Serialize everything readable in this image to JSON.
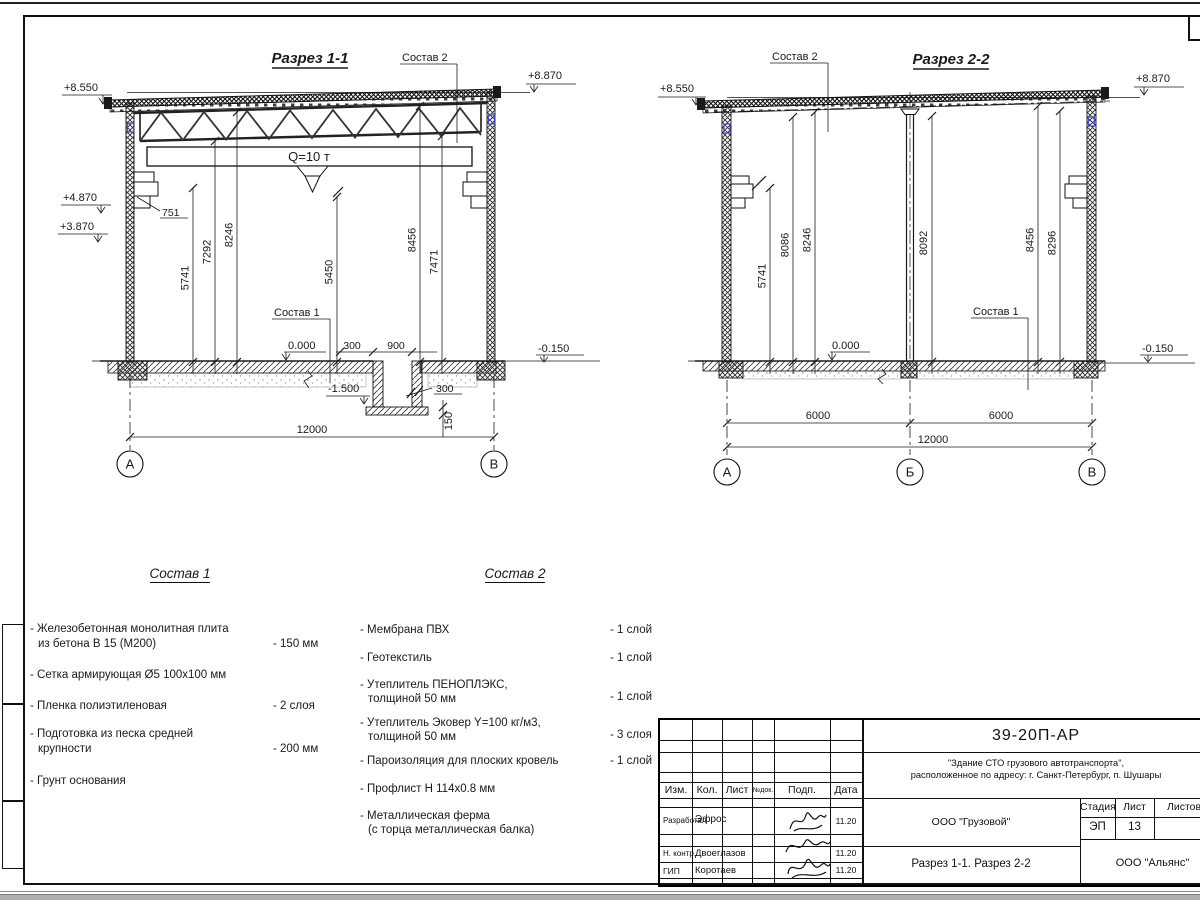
{
  "section1": {
    "title": "Разрез 1-1",
    "sostav2_label": "Состав 2",
    "sostav1_label": "Состав 1",
    "crane_label": "Q=10 т",
    "elev_left_top": "+8.550",
    "elev_right_top": "+8.870",
    "elev_l1": "+4.870",
    "elev_l2": "+3.870",
    "lvl_zero": "0.000",
    "lvl_minus015": "-0.150",
    "lvl_minus150": "-1.500",
    "dim_751": "751",
    "dim_v1": "5741",
    "dim_v2": "7292",
    "dim_v3": "8246",
    "dim_v4": "5450",
    "dim_v5": "8456",
    "dim_v6": "7471",
    "dim_300a": "300",
    "dim_900": "900",
    "dim_300b": "300",
    "dim_150": "150",
    "dim_total": "12000",
    "axis_a": "А",
    "axis_b": "В"
  },
  "section2": {
    "title": "Разрез 2-2",
    "sostav2_label": "Состав 2",
    "sostav1_label": "Состав 1",
    "elev_left_top": "+8.550",
    "elev_right_top": "+8.870",
    "lvl_zero": "0.000",
    "lvl_minus015": "-0.150",
    "dim_v1": "5741",
    "dim_v2": "8086",
    "dim_v3": "8246",
    "dim_v4": "8092",
    "dim_v5": "8456",
    "dim_v6": "8296",
    "dim_span1": "6000",
    "dim_span2": "6000",
    "dim_total": "12000",
    "axis_a": "А",
    "axis_b": "Б",
    "axis_v": "В"
  },
  "sostav1": {
    "title": "Состав 1",
    "items": [
      {
        "l1": "- Железобетонная  монолитная плита",
        "l2": "из бетона В 15 (М200)",
        "qty": "- 150 мм"
      },
      {
        "l1": "- Сетка армирующая Ø5 100х100 мм",
        "l2": "",
        "qty": ""
      },
      {
        "l1": "- Пленка полиэтиленовая",
        "l2": "",
        "qty": "-  2 слоя"
      },
      {
        "l1": "- Подготовка из песка средней",
        "l2": "крупности",
        "qty": "- 200 мм"
      },
      {
        "l1": "- Грунт основания",
        "l2": "",
        "qty": ""
      }
    ]
  },
  "sostav2": {
    "title": "Состав 2",
    "items": [
      {
        "l1": "- Мембрана ПВХ",
        "l2": "",
        "qty": "- 1 слой"
      },
      {
        "l1": "- Геотекстиль",
        "l2": "",
        "qty": "- 1 слой"
      },
      {
        "l1": "- Утеплитель ПЕНОПЛЭКС,",
        "l2": "толщиной 50 мм",
        "qty": "- 1 слой"
      },
      {
        "l1": "- Утеплитель Эковер Y=100 кг/м3,",
        "l2": "толщиной 50 мм",
        "qty": "- 3 слоя"
      },
      {
        "l1": "- Пароизоляция для плоских кровель",
        "l2": "",
        "qty": "- 1 слой"
      },
      {
        "l1": "- Профлист Н 114х0.8 мм",
        "l2": "",
        "qty": ""
      },
      {
        "l1": "- Металлическая ферма",
        "l2": "(с торца металлическая балка)",
        "qty": ""
      }
    ]
  },
  "titleblock": {
    "doc_number": "39-20П-АР",
    "project_line1": "\"Здание СТО грузового автотранспорта\",",
    "project_line2": "расположенное по адресу: г. Санкт-Петербург, п. Шушары",
    "col_izm": "Изм.",
    "col_kol": "Кол.",
    "col_list": "Лист",
    "col_ndok": "№док.",
    "col_podp": "Подп.",
    "col_data": "Дата",
    "row1_role": "Разработал",
    "row1_name": "Эфрос",
    "row1_date": "11.20",
    "row2_role": "Н. контр.",
    "row2_name": "Двоеглазов",
    "row2_date": "11.20",
    "row3_role": "ГИП",
    "row3_name": "Коротаев",
    "row3_date": "11.20",
    "company": "ООО \"Грузовой\"",
    "stage_label": "Стадия",
    "sheet_label": "Лист",
    "sheets_label": "Листов",
    "stage_value": "ЭП",
    "sheet_value": "13",
    "content_title": "Разрез 1-1. Разрез 2-2",
    "contractor": "ООО \"Альянс\""
  }
}
